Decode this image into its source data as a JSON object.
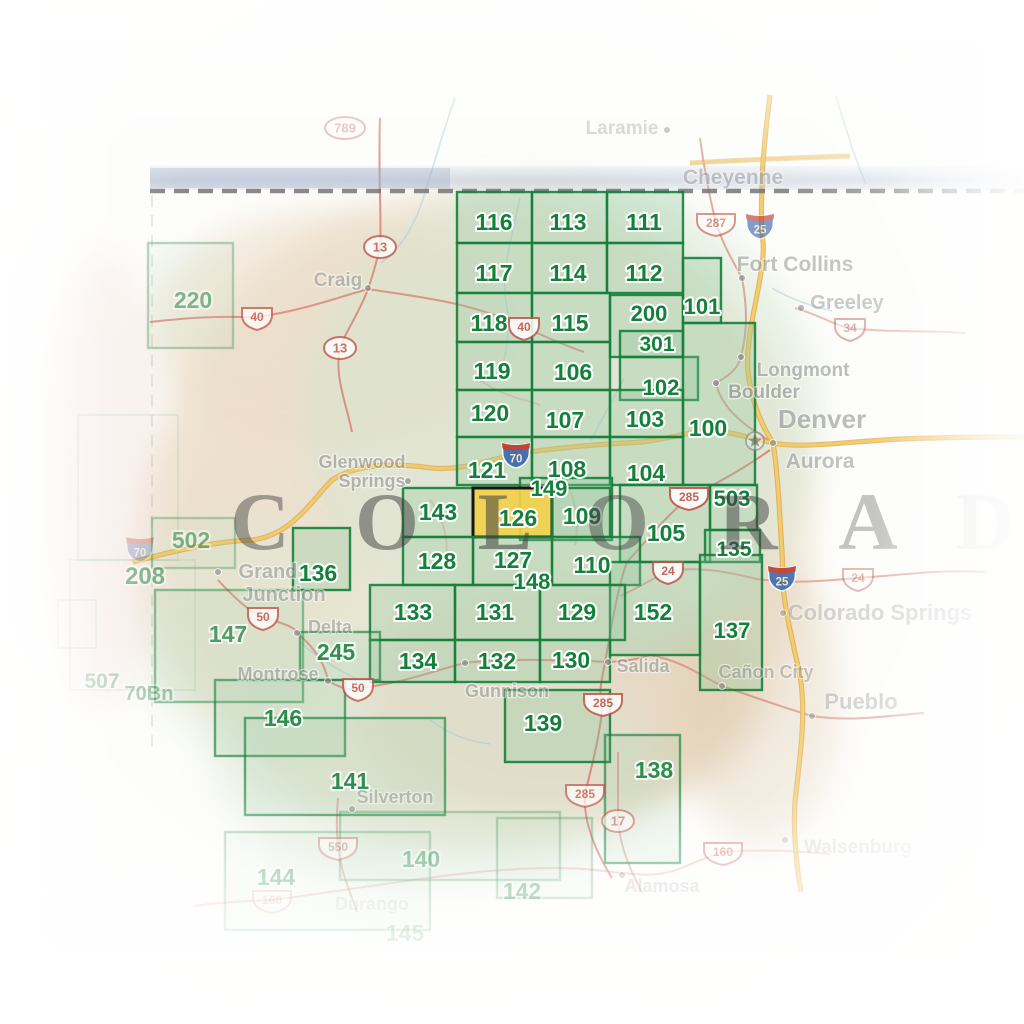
{
  "map_title": "Colorado recreation map index",
  "state_name_letters": [
    {
      "ch": "C",
      "x": 260,
      "o": 0.45
    },
    {
      "ch": "O",
      "x": 387,
      "o": 0.5
    },
    {
      "ch": "L",
      "x": 505,
      "o": 0.55
    },
    {
      "ch": "O",
      "x": 617,
      "o": 0.45
    },
    {
      "ch": "R",
      "x": 748,
      "o": 0.5
    },
    {
      "ch": "A",
      "x": 868,
      "o": 0.3
    },
    {
      "ch": "D",
      "x": 985,
      "o": 0.1
    }
  ],
  "highlighted_quad": "126",
  "quads": [
    {
      "n": "116",
      "x": 457,
      "y": 192,
      "w": 75,
      "h": 51,
      "lx": 494,
      "ly": 230,
      "s": "b"
    },
    {
      "n": "113",
      "x": 532,
      "y": 192,
      "w": 75,
      "h": 51,
      "lx": 568,
      "ly": 230,
      "s": "b"
    },
    {
      "n": "111",
      "x": 607,
      "y": 192,
      "w": 76,
      "h": 51,
      "lx": 644,
      "ly": 230,
      "s": "b"
    },
    {
      "n": "117",
      "x": 457,
      "y": 243,
      "w": 75,
      "h": 50,
      "lx": 494,
      "ly": 281,
      "s": "b"
    },
    {
      "n": "114",
      "x": 532,
      "y": 243,
      "w": 75,
      "h": 50,
      "lx": 568,
      "ly": 281,
      "s": "b"
    },
    {
      "n": "112",
      "x": 607,
      "y": 243,
      "w": 76,
      "h": 50,
      "lx": 644,
      "ly": 281,
      "s": "b"
    },
    {
      "n": "118",
      "x": 457,
      "y": 293,
      "w": 75,
      "h": 49,
      "lx": 489,
      "ly": 331,
      "s": "b"
    },
    {
      "n": "115",
      "x": 532,
      "y": 293,
      "w": 78,
      "h": 49,
      "lx": 570,
      "ly": 331,
      "s": "b"
    },
    {
      "n": "200",
      "x": 610,
      "y": 295,
      "w": 73,
      "h": 62,
      "lx": 649,
      "ly": 321,
      "s": "b",
      "fs": 22
    },
    {
      "n": "301",
      "x": 620,
      "y": 331,
      "w": 63,
      "h": 26,
      "lx": 657,
      "ly": 351,
      "s": "b",
      "fs": 21
    },
    {
      "n": "101",
      "x": 683,
      "y": 258,
      "w": 38,
      "h": 65,
      "lx": 702,
      "ly": 314,
      "s": "b",
      "fs": 22
    },
    {
      "n": "102",
      "x": 620,
      "y": 357,
      "w": 78,
      "h": 43,
      "lx": 661,
      "ly": 395,
      "s": "b",
      "fs": 22
    },
    {
      "n": "119",
      "x": 457,
      "y": 342,
      "w": 75,
      "h": 48,
      "lx": 492,
      "ly": 379,
      "s": "b"
    },
    {
      "n": "106",
      "x": 532,
      "y": 342,
      "w": 78,
      "h": 48,
      "lx": 573,
      "ly": 380,
      "s": "b"
    },
    {
      "n": "120",
      "x": 457,
      "y": 390,
      "w": 75,
      "h": 47,
      "lx": 490,
      "ly": 421,
      "s": "b"
    },
    {
      "n": "107",
      "x": 532,
      "y": 390,
      "w": 78,
      "h": 47,
      "lx": 565,
      "ly": 428,
      "s": "b"
    },
    {
      "n": "103",
      "x": 610,
      "y": 390,
      "w": 73,
      "h": 47,
      "lx": 645,
      "ly": 427,
      "s": "b"
    },
    {
      "n": "100",
      "x": 683,
      "y": 323,
      "w": 72,
      "h": 162,
      "lx": 708,
      "ly": 436,
      "s": "b"
    },
    {
      "n": "121",
      "x": 457,
      "y": 437,
      "w": 75,
      "h": 48,
      "lx": 487,
      "ly": 478,
      "s": "b"
    },
    {
      "n": "108",
      "x": 532,
      "y": 437,
      "w": 78,
      "h": 48,
      "lx": 567,
      "ly": 477,
      "s": "b"
    },
    {
      "n": "104",
      "x": 610,
      "y": 437,
      "w": 73,
      "h": 48,
      "lx": 646,
      "ly": 481,
      "s": "b"
    },
    {
      "n": "149",
      "x": 520,
      "y": 478,
      "w": 92,
      "h": 62,
      "lx": 549,
      "ly": 496,
      "s": "b",
      "fs": 22
    },
    {
      "n": "143",
      "x": 403,
      "y": 488,
      "w": 70,
      "h": 49,
      "lx": 438,
      "ly": 520,
      "s": "b"
    },
    {
      "n": "126",
      "x": 473,
      "y": 488,
      "w": 79,
      "h": 49,
      "lx": 518,
      "ly": 526,
      "s": "h"
    },
    {
      "n": "109",
      "x": 552,
      "y": 488,
      "w": 58,
      "h": 49,
      "lx": 582,
      "ly": 524,
      "s": "b"
    },
    {
      "n": "503",
      "x": 710,
      "y": 485,
      "w": 47,
      "h": 45,
      "lx": 732,
      "ly": 506,
      "s": "b",
      "fs": 22
    },
    {
      "n": "105",
      "x": 620,
      "y": 485,
      "w": 90,
      "h": 77,
      "lx": 666,
      "ly": 541,
      "s": "b"
    },
    {
      "n": "135",
      "x": 705,
      "y": 530,
      "w": 55,
      "h": 32,
      "lx": 734,
      "ly": 556,
      "s": "b",
      "fs": 21
    },
    {
      "n": "110",
      "x": 552,
      "y": 537,
      "w": 88,
      "h": 48,
      "lx": 592,
      "ly": 573,
      "s": "b"
    },
    {
      "n": "127",
      "x": 473,
      "y": 537,
      "w": 79,
      "h": 48,
      "lx": 513,
      "ly": 568,
      "s": "b"
    },
    {
      "n": "128",
      "x": 403,
      "y": 537,
      "w": 70,
      "h": 48,
      "lx": 437,
      "ly": 569,
      "s": "b"
    },
    {
      "n": "148",
      "lx": 532,
      "ly": 589,
      "s": "b",
      "fs": 22
    },
    {
      "n": "152",
      "x": 610,
      "y": 562,
      "w": 90,
      "h": 93,
      "lx": 653,
      "ly": 620,
      "s": "b"
    },
    {
      "n": "137",
      "x": 700,
      "y": 555,
      "w": 62,
      "h": 135,
      "lx": 732,
      "ly": 638,
      "s": "b",
      "fs": 22
    },
    {
      "n": "133",
      "x": 370,
      "y": 585,
      "w": 85,
      "h": 55,
      "lx": 413,
      "ly": 620,
      "s": "b"
    },
    {
      "n": "131",
      "x": 455,
      "y": 585,
      "w": 85,
      "h": 55,
      "lx": 495,
      "ly": 620,
      "s": "b"
    },
    {
      "n": "129",
      "x": 540,
      "y": 585,
      "w": 85,
      "h": 55,
      "lx": 577,
      "ly": 620,
      "s": "b"
    },
    {
      "n": "134",
      "x": 370,
      "y": 640,
      "w": 85,
      "h": 42,
      "lx": 418,
      "ly": 669,
      "s": "b"
    },
    {
      "n": "132",
      "x": 455,
      "y": 640,
      "w": 85,
      "h": 42,
      "lx": 497,
      "ly": 669,
      "s": "b"
    },
    {
      "n": "130",
      "x": 540,
      "y": 640,
      "w": 70,
      "h": 42,
      "lx": 571,
      "ly": 668,
      "s": "b"
    },
    {
      "n": "136",
      "x": 293,
      "y": 528,
      "w": 57,
      "h": 62,
      "lx": 318,
      "ly": 581,
      "s": "b"
    },
    {
      "n": "245",
      "x": 300,
      "y": 632,
      "w": 80,
      "h": 48,
      "lx": 336,
      "ly": 660,
      "s": "bm"
    },
    {
      "n": "146",
      "x": 215,
      "y": 680,
      "w": 130,
      "h": 76,
      "lx": 283,
      "ly": 726,
      "s": "bm"
    },
    {
      "n": "139",
      "x": 505,
      "y": 690,
      "w": 105,
      "h": 72,
      "lx": 543,
      "ly": 731,
      "s": "b"
    },
    {
      "n": "141",
      "x": 245,
      "y": 718,
      "w": 200,
      "h": 97,
      "lx": 350,
      "ly": 789,
      "s": "bm"
    },
    {
      "n": "138",
      "x": 605,
      "y": 735,
      "w": 75,
      "h": 128,
      "lx": 654,
      "ly": 778,
      "s": "bm"
    },
    {
      "n": "147",
      "x": 155,
      "y": 590,
      "w": 148,
      "h": 112,
      "lx": 228,
      "ly": 642,
      "s": "m"
    },
    {
      "n": "220",
      "x": 148,
      "y": 243,
      "w": 85,
      "h": 105,
      "lx": 193,
      "ly": 308,
      "s": "f"
    },
    {
      "n": "502",
      "x": 152,
      "y": 518,
      "w": 83,
      "h": 50,
      "lx": 191,
      "ly": 548,
      "s": "f"
    },
    {
      "n": "144",
      "x": 225,
      "y": 832,
      "w": 205,
      "h": 98,
      "lx": 276,
      "ly": 885,
      "s": "f"
    },
    {
      "n": "140",
      "x": 340,
      "y": 812,
      "w": 220,
      "h": 68,
      "lx": 421,
      "ly": 867,
      "s": "f"
    },
    {
      "n": "142",
      "x": 497,
      "y": 818,
      "w": 95,
      "h": 80,
      "lx": 522,
      "ly": 899,
      "s": "f"
    },
    {
      "n": "145",
      "lx": 405,
      "ly": 941,
      "s": "u"
    },
    {
      "n": "208",
      "lx": 145,
      "ly": 584,
      "s": "f",
      "fs": 24
    },
    {
      "n": "507",
      "lx": 102,
      "ly": 688,
      "s": "u",
      "fs": 21
    },
    {
      "n": "70Bn",
      "lx": 149,
      "ly": 700,
      "s": "u",
      "fs": 20
    }
  ],
  "cities": [
    {
      "t": "Laramie",
      "x": 622,
      "y": 134,
      "fs": 19,
      "o": 0.38,
      "dx": 667,
      "dy": 130
    },
    {
      "t": "Cheyenne",
      "x": 733,
      "y": 184,
      "fs": 21,
      "o": 0.42
    },
    {
      "t": "Fort Collins",
      "x": 795,
      "y": 271,
      "fs": 21,
      "o": 0.5,
      "dx": 742,
      "dy": 278
    },
    {
      "t": "Greeley",
      "x": 847,
      "y": 309,
      "fs": 20,
      "o": 0.45,
      "dx": 801,
      "dy": 308
    },
    {
      "t": "Longmont",
      "x": 803,
      "y": 376,
      "fs": 19,
      "o": 0.55,
      "dx": 741,
      "dy": 357
    },
    {
      "t": "Boulder",
      "x": 764,
      "y": 398,
      "fs": 19,
      "o": 0.6,
      "dx": 716,
      "dy": 383
    },
    {
      "t": "Denver",
      "x": 822,
      "y": 428,
      "fs": 26,
      "o": 0.55,
      "dx": 773,
      "dy": 443
    },
    {
      "t": "Aurora",
      "x": 820,
      "y": 468,
      "fs": 21,
      "o": 0.5
    },
    {
      "t": "Craig",
      "x": 338,
      "y": 286,
      "fs": 19,
      "o": 0.5,
      "dx": 368,
      "dy": 288
    },
    {
      "t": "Glenwood",
      "x": 362,
      "y": 468,
      "fs": 18,
      "o": 0.55
    },
    {
      "t": "Springs",
      "x": 372,
      "y": 487,
      "fs": 18,
      "o": 0.55,
      "dx": 408,
      "dy": 481
    },
    {
      "t": "Grand",
      "x": 268,
      "y": 578,
      "fs": 20,
      "o": 0.5,
      "dx": 218,
      "dy": 572
    },
    {
      "t": "Junction",
      "x": 284,
      "y": 601,
      "fs": 20,
      "o": 0.5
    },
    {
      "t": "Delta",
      "x": 330,
      "y": 633,
      "fs": 18,
      "o": 0.5,
      "dx": 297,
      "dy": 633
    },
    {
      "t": "Montrose",
      "x": 278,
      "y": 680,
      "fs": 18,
      "o": 0.5,
      "dx": 328,
      "dy": 681
    },
    {
      "t": "Gunnison",
      "x": 507,
      "y": 697,
      "fs": 18,
      "o": 0.5,
      "dx": 465,
      "dy": 663
    },
    {
      "t": "Salida",
      "x": 643,
      "y": 672,
      "fs": 18,
      "o": 0.5,
      "dx": 608,
      "dy": 662
    },
    {
      "t": "Colorado Springs",
      "x": 880,
      "y": 620,
      "fs": 22,
      "o": 0.33,
      "dx": 783,
      "dy": 613
    },
    {
      "t": "Cañon City",
      "x": 766,
      "y": 678,
      "fs": 18,
      "o": 0.45,
      "dx": 722,
      "dy": 686
    },
    {
      "t": "Pueblo",
      "x": 861,
      "y": 709,
      "fs": 22,
      "o": 0.4,
      "dx": 812,
      "dy": 716
    },
    {
      "t": "Silverton",
      "x": 395,
      "y": 803,
      "fs": 18,
      "o": 0.45,
      "dx": 352,
      "dy": 809
    },
    {
      "t": "Alamosa",
      "x": 662,
      "y": 892,
      "fs": 18,
      "o": 0.3,
      "dx": 622,
      "dy": 875
    },
    {
      "t": "Walsenburg",
      "x": 858,
      "y": 853,
      "fs": 19,
      "o": 0.28,
      "dx": 785,
      "dy": 840
    },
    {
      "t": "Durango",
      "x": 372,
      "y": 910,
      "fs": 18,
      "o": 0.22
    }
  ],
  "route_shields": [
    {
      "n": "789",
      "k": "oval",
      "x": 345,
      "y": 128,
      "o": 0.4
    },
    {
      "n": "13",
      "k": "oval",
      "x": 380,
      "y": 247,
      "o": 0.8
    },
    {
      "n": "13",
      "k": "oval",
      "x": 340,
      "y": 348,
      "o": 0.8
    },
    {
      "n": "40",
      "k": "us",
      "x": 257,
      "y": 317,
      "o": 0.75
    },
    {
      "n": "40",
      "k": "us",
      "x": 524,
      "y": 327,
      "o": 0.85
    },
    {
      "n": "287",
      "k": "us",
      "x": 716,
      "y": 223,
      "o": 0.6
    },
    {
      "n": "25",
      "k": "i",
      "x": 760,
      "y": 225,
      "o": 0.65
    },
    {
      "n": "25",
      "k": "i",
      "x": 782,
      "y": 577,
      "o": 0.9
    },
    {
      "n": "34",
      "k": "us",
      "x": 850,
      "y": 328,
      "o": 0.45
    },
    {
      "n": "70",
      "k": "i",
      "x": 516,
      "y": 454,
      "o": 0.95
    },
    {
      "n": "70",
      "k": "i",
      "x": 140,
      "y": 548,
      "o": 0.3
    },
    {
      "n": "285",
      "k": "us",
      "x": 689,
      "y": 497,
      "o": 0.9
    },
    {
      "n": "285",
      "k": "us",
      "x": 603,
      "y": 703,
      "o": 0.85
    },
    {
      "n": "285",
      "k": "us",
      "x": 585,
      "y": 794,
      "o": 0.7
    },
    {
      "n": "24",
      "k": "us",
      "x": 668,
      "y": 571,
      "o": 0.85
    },
    {
      "n": "24",
      "k": "us",
      "x": 858,
      "y": 578,
      "o": 0.4
    },
    {
      "n": "50",
      "k": "us",
      "x": 263,
      "y": 617,
      "o": 0.8
    },
    {
      "n": "50",
      "k": "us",
      "x": 358,
      "y": 688,
      "o": 0.8
    },
    {
      "n": "550",
      "k": "us",
      "x": 338,
      "y": 847,
      "o": 0.45
    },
    {
      "n": "160",
      "k": "us",
      "x": 723,
      "y": 852,
      "o": 0.55
    },
    {
      "n": "160",
      "k": "us",
      "x": 272,
      "y": 900,
      "o": 0.25
    },
    {
      "n": "17",
      "k": "oval",
      "x": 618,
      "y": 821,
      "o": 0.6
    }
  ],
  "colors": {
    "quad_green": "#15803c",
    "quad_fill": "#8fc79b",
    "highlight_yellow": "#f1d04b",
    "highlight_border": "#151515",
    "city_gray": "#8a8a8a",
    "letter_gray": "#3f3f3f",
    "road_red": "#d4766b",
    "interstate_yellow": "#f5cf6a",
    "interstate_casing": "#dca344",
    "river_teal": "#a3c9d6",
    "shield_red": "#c4564c",
    "interstate_blue": "#3f6cb0",
    "interstate_band_red": "#c03a31",
    "border_dash_gray": "#6e6e72",
    "border_band_blue": "#aebad2"
  }
}
